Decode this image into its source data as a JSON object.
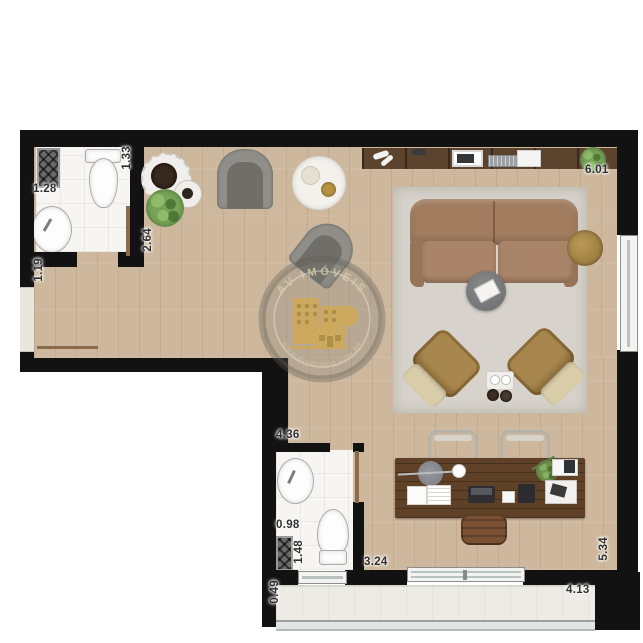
{
  "watermark": {
    "top_text": "AV IMÓVEIS",
    "bottom_text": "WWW.AVIMOVEIS.COM.BR"
  },
  "dimensions": {
    "bath1_width": "1.28",
    "bath1_length": "1.33",
    "hall_width": "1.19",
    "kitchen_wall": "2.64",
    "living_top": "6.01",
    "bath2_wall": "4.36",
    "bath2_width": "0.98",
    "bath2_length": "1.48",
    "living_left": "3.24",
    "balcony_end": "0.49",
    "balcony_width": "4.13",
    "living_right": "5.34"
  },
  "colors": {
    "wall": "#121212",
    "wood_floor": "#cdb89e",
    "bathroom_tile": "#f6f5f2",
    "rug": "#d7d3cc",
    "sofa": "#a17c5f",
    "armchair_mustard": "#a8874e",
    "armchair_gray": "#8f8e89",
    "desk_walnut": "#5f4127",
    "balcony_tile": "#ecebe5",
    "watermark_gold": "#d9ab3e",
    "door": "#8a6b4a"
  }
}
